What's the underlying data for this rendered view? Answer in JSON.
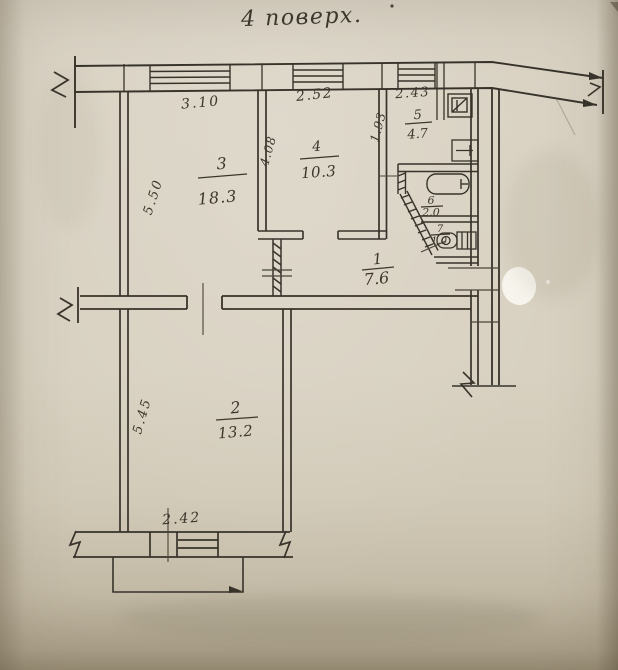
{
  "title": "4 поверх.",
  "plan": {
    "rooms": [
      {
        "number": "1",
        "area": "7.6"
      },
      {
        "number": "2",
        "area": "13.2"
      },
      {
        "number": "3",
        "area": "18.3"
      },
      {
        "number": "4",
        "area": "10.3"
      },
      {
        "number": "5",
        "area": "4.7"
      },
      {
        "number": "6",
        "area": "2.0"
      },
      {
        "number": "7",
        "area": "1.0"
      }
    ],
    "dimensions": {
      "room3_width": "3.10",
      "room4_width": "2.52",
      "room5_width": "2.43",
      "room5_depth": "1.93",
      "room4_depth": "4.08",
      "room3_depth": "5.50",
      "room2_depth": "5.45",
      "balcony_wall_width": "2.42"
    },
    "colors": {
      "paper": "#d8d1c1",
      "ink": "#3a352b"
    }
  }
}
